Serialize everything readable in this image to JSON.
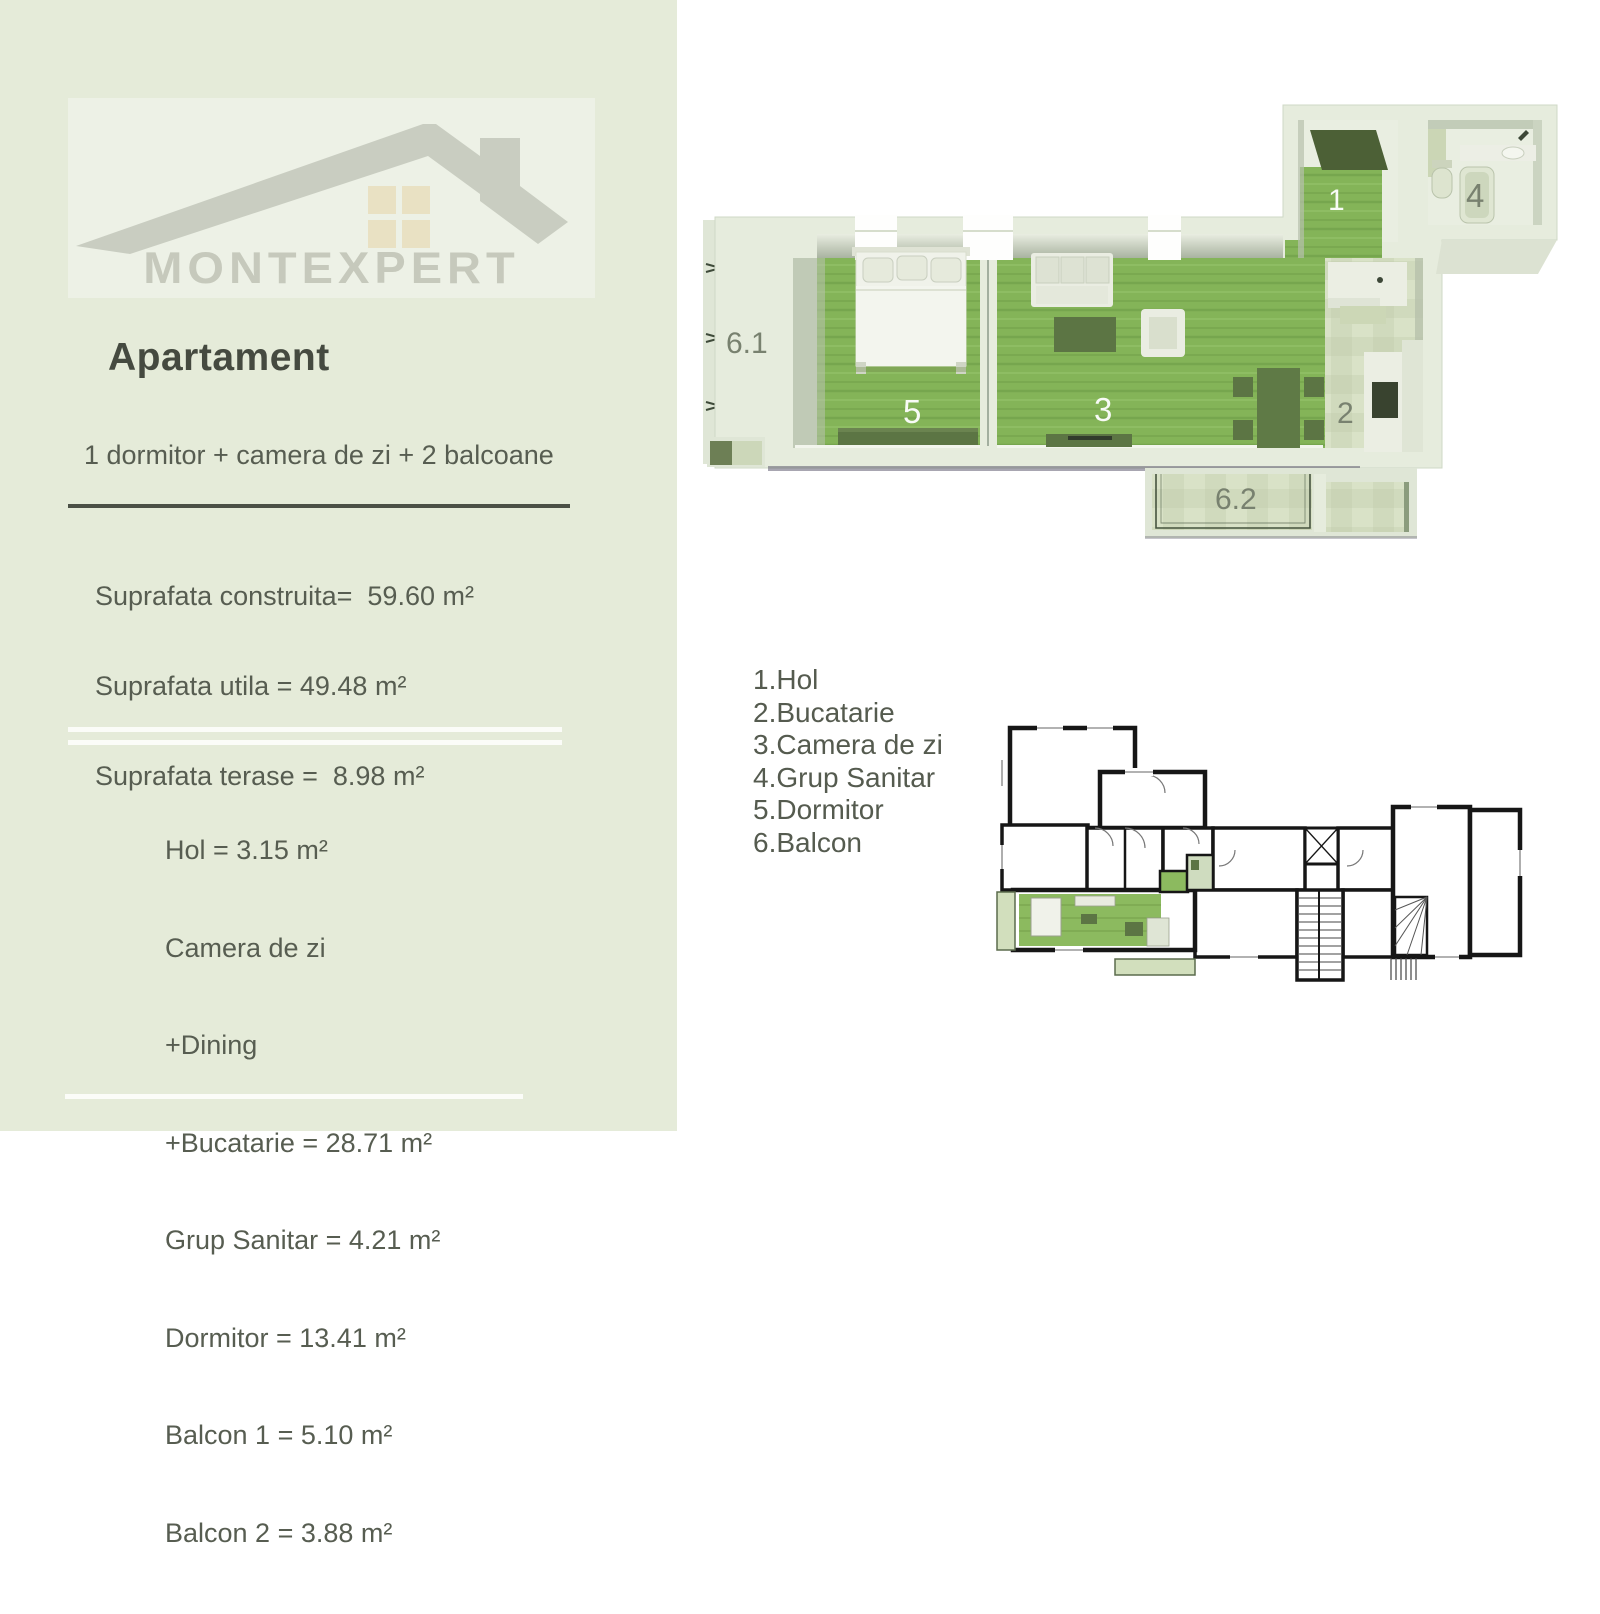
{
  "sidebar": {
    "brand": "MONTEXPERT",
    "title": "Apartament",
    "subtitle": "1 dormitor + camera de zi + 2 balcoane",
    "surface_lines": [
      "Suprafata construita=  59.60 m²",
      "Suprafata utila = 49.48 m²",
      "Suprafata terase =  8.98 m²"
    ],
    "rooms": [
      "Hol = 3.15 m²",
      "Camera de zi",
      "+Dining",
      "+Bucatarie = 28.71 m²",
      "Grup Sanitar = 4.21 m²",
      "Dormitor = 13.41 m²",
      "Balcon 1 = 5.10 m²",
      "Balcon 2 = 3.88 m²"
    ]
  },
  "legend": {
    "items": [
      "1.Hol",
      "2.Bucatarie",
      "3.Camera de zi",
      "4.Grup Sanitar",
      "5.Dormitor",
      "6.Balcon"
    ]
  },
  "plan_labels": {
    "hall": "1",
    "kitchen": "2",
    "living": "3",
    "bath": "4",
    "bedroom": "5",
    "balcony1": "6.1",
    "balcony2": "6.2"
  },
  "colors": {
    "sidebar_bg": "#e5ebd9",
    "logo_panel_bg": "#edf1e6",
    "logo_gray": "#c6c9bc",
    "title_text": "#454a40",
    "body_text": "#575d51",
    "rule_dark": "#4b5046",
    "wall": "#e6ecdd",
    "floor_green": "#85b45a",
    "tile_pale": "#d0dabd",
    "furniture_green": "#5c7544",
    "plan2d_wall": "#161616"
  }
}
